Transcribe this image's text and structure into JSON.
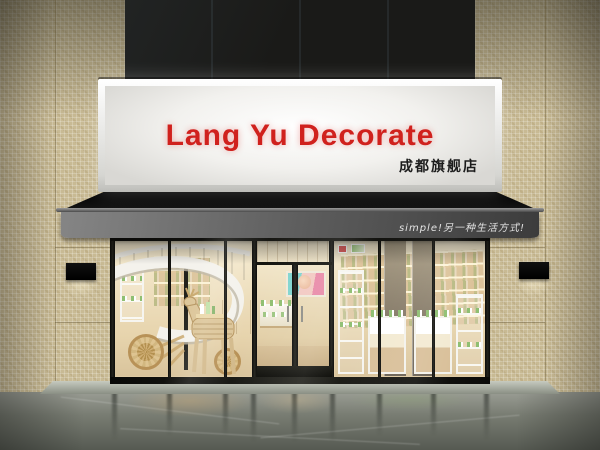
{
  "sign": {
    "title": "Lang Yu Decorate",
    "subtitle": "成都旗舰店"
  },
  "awning": {
    "slogan": "simple!另一种生活方式!"
  },
  "colors": {
    "sign_text_red": "#d0211d",
    "sign_panel_white": "#f2f1ee",
    "awning_black": "#0b0b0b",
    "awning_valance_grey": "#5a5a5a",
    "tile_beige": "#c8ba94",
    "storefront_frame_black": "#17170f",
    "interior_warm_cream": "#ecdebd",
    "wood_tan": "#d3b98c",
    "product_green": "#8fbf72",
    "floor_grey_green": "#787c72",
    "upper_facade_navy": "#0d1722"
  }
}
